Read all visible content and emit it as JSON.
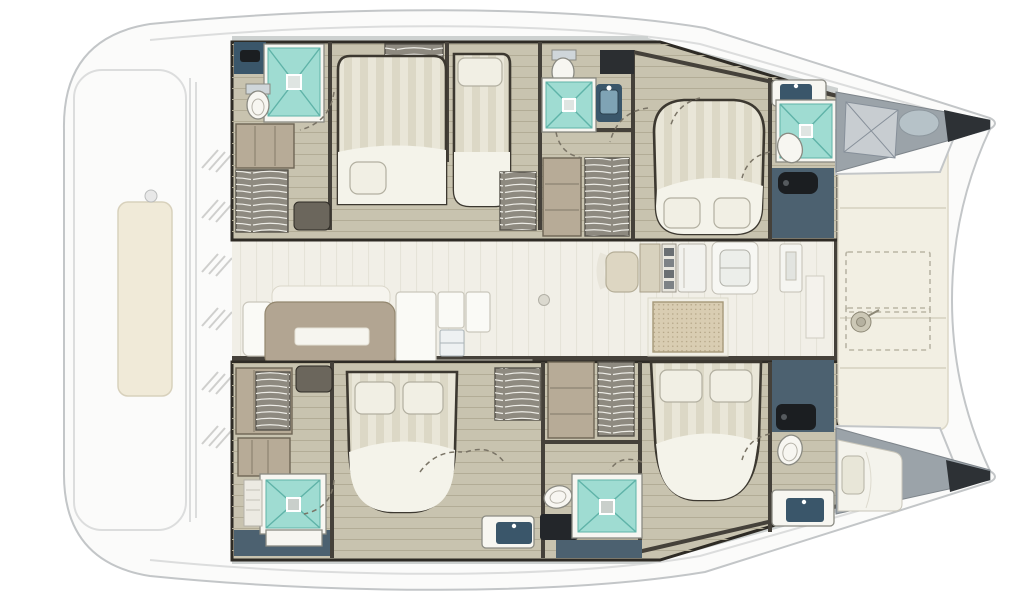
{
  "canvas": {
    "width": 1024,
    "height": 600
  },
  "colors": {
    "bg": "#ffffff",
    "hull_fill": "#fbfbfa",
    "hull_line": "#c3c6c8",
    "deck_line": "#dcdddd",
    "sunpad": "#f0ead8",
    "sunpad_line": "#d8d1bc",
    "foredeck": "#f2efe3",
    "foredeck_line": "#dcd8c8",
    "dash_line": "#b9b5a5",
    "bow_gray": "#9ba3a9",
    "bow_gray_light": "#c8cdd1",
    "bow_dark": "#2d3135",
    "wall_dark": "#45413a",
    "wall_darker": "#2e2b25",
    "hull_floor": "#c8c3af",
    "hull_floor_line": "#b2ac96",
    "salon_floor": "#f1efe7",
    "salon_floor_line": "#e5e3d8",
    "navy": "#4c6170",
    "navy_dark": "#3a566a",
    "black_fixture": "#1b1e21",
    "teal": "#9fdcd2",
    "teal_light": "#cdeee8",
    "teal_line": "#5fb3a8",
    "white_fixture": "#f7f6f1",
    "fixture_line": "#8a8a82",
    "bed_stripe_a": "#e9e6d8",
    "bed_stripe_b": "#dcd8c6",
    "bed_sheet": "#f4f3ea",
    "bed_outline": "#3c3830",
    "pillow": "#f1efe4",
    "wood_shelf": "#b7ab97",
    "wood_shelf_line": "#8d8472",
    "locker_gray": "#8e8a80",
    "bench_gray": "#a9a79e",
    "seat_beige": "#ddd6c2",
    "dinette_taupe": "#b2a592",
    "dinette_slot": "#f6f5ef",
    "grate_bg": "#d9cdb2",
    "grate_dot": "#b2a384",
    "step_light": "#dedcd2",
    "door_arc": "#7a7466"
  },
  "plan": {
    "vessel_type": "catamaran",
    "view": "top-down interior layout",
    "areas": {
      "aft_platform": [
        "sunpad",
        "deck-hatches"
      ],
      "port_hull": [
        "head-with-shower",
        "double-berth-cabin",
        "single-berth-cabin",
        "shower-room",
        "island-double-cabin",
        "forward-head",
        "forepeak-locker"
      ],
      "salon": [
        "dinette-sofa",
        "dinette-table",
        "galley-units",
        "nav-seat",
        "galley-counter-sink",
        "engine-hatch-grate"
      ],
      "starboard_hull": [
        "wardrobe",
        "shower-room",
        "island-double-cabin",
        "mid-shower-room",
        "island-double-cabin-fwd",
        "forward-head",
        "forepeak-berth"
      ],
      "foredeck": [
        "storage-lockers",
        "windlass"
      ]
    },
    "fixture_counts": {
      "showers": 5,
      "toilets": 5,
      "sinks": 4,
      "double_beds": 4,
      "single_beds": 2
    }
  }
}
